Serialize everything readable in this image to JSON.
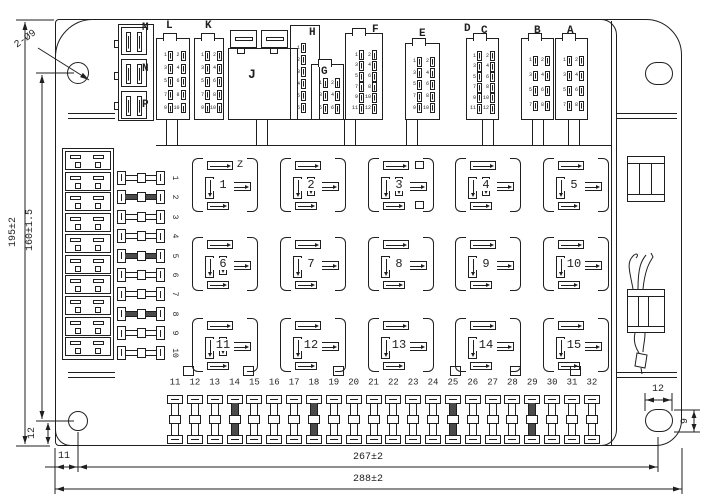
{
  "drawing": {
    "type": "fuse-and-relay-box engineering drawing",
    "line_color": "#1f1f1f",
    "bg_color": "#ffffff"
  },
  "dimensions": {
    "hole_callout": "2-Ø9",
    "height_overall": "195±2",
    "height_holes": "160±1.5",
    "bottom_offset_left": "12",
    "left_offset": "11",
    "width_holes": "267±2",
    "width_overall": "288±2",
    "slot_width": "12",
    "slot_height": "9"
  },
  "connectors": {
    "labels": {
      "m": "M",
      "n": "N",
      "p": "P",
      "l": "L",
      "k": "K",
      "j": "J",
      "h": "H",
      "g": "G",
      "f": "F",
      "e": "E",
      "d": "D",
      "c": "C",
      "b": "B",
      "a": "A"
    },
    "blocks": [
      {
        "id": "L",
        "rows": 5,
        "cols": 2,
        "pins": [
          "1",
          "3",
          "5",
          "7",
          "9",
          "2",
          "4",
          "6",
          "8",
          "10"
        ]
      },
      {
        "id": "K",
        "rows": 5,
        "cols": 2,
        "pins": [
          "1",
          "3",
          "5",
          "7",
          "9",
          "2",
          "4",
          "6",
          "8",
          "10"
        ]
      },
      {
        "id": "H",
        "rows": 6,
        "cols": 1,
        "pins": [
          "1",
          "2",
          "3",
          "4",
          "5",
          "6"
        ]
      },
      {
        "id": "G",
        "rows": 3,
        "cols": 2,
        "pins": [
          "1",
          "3",
          "5",
          "2",
          "4",
          "6"
        ]
      },
      {
        "id": "F",
        "rows": 6,
        "cols": 2,
        "pins": [
          "1",
          "3",
          "5",
          "7",
          "9",
          "11",
          "2",
          "4",
          "6",
          "8",
          "10",
          "12"
        ]
      },
      {
        "id": "E",
        "rows": 5,
        "cols": 2,
        "pins": [
          "1",
          "3",
          "5",
          "7",
          "9",
          "2",
          "4",
          "6",
          "8",
          "10"
        ]
      },
      {
        "id": "DC",
        "rows": 6,
        "cols": 2,
        "pins": [
          "1",
          "3",
          "5",
          "7",
          "9",
          "11",
          "2",
          "4",
          "6",
          "8",
          "10",
          "12"
        ]
      },
      {
        "id": "B",
        "rows": 4,
        "cols": 2,
        "pins": [
          "1",
          "3",
          "5",
          "7",
          "2",
          "4",
          "6",
          "8"
        ]
      },
      {
        "id": "A",
        "rows": 4,
        "cols": 2,
        "pins": [
          "1",
          "3",
          "5",
          "7",
          "2",
          "4",
          "6",
          "8"
        ]
      }
    ]
  },
  "relays": {
    "z_label": "Z",
    "sockets": [
      {
        "n": "1",
        "mid": false,
        "extra": false
      },
      {
        "n": "2",
        "mid": true,
        "extra": false
      },
      {
        "n": "3",
        "mid": true,
        "extra": true
      },
      {
        "n": "4",
        "mid": true,
        "extra": false
      },
      {
        "n": "5",
        "mid": false,
        "extra": false
      },
      {
        "n": "6",
        "mid": true,
        "extra": false
      },
      {
        "n": "7",
        "mid": false,
        "extra": false
      },
      {
        "n": "8",
        "mid": false,
        "extra": false
      },
      {
        "n": "9",
        "mid": false,
        "extra": false
      },
      {
        "n": "10",
        "mid": false,
        "extra": false
      },
      {
        "n": "11",
        "mid": true,
        "extra": false
      },
      {
        "n": "12",
        "mid": false,
        "extra": false
      },
      {
        "n": "13",
        "mid": false,
        "extra": false
      },
      {
        "n": "14",
        "mid": false,
        "extra": false
      },
      {
        "n": "15",
        "mid": false,
        "extra": false
      }
    ]
  },
  "fuses": {
    "left_column": [
      {
        "n": "1",
        "shaded": false
      },
      {
        "n": "2",
        "shaded": true
      },
      {
        "n": "3",
        "shaded": false
      },
      {
        "n": "4",
        "shaded": false
      },
      {
        "n": "5",
        "shaded": true
      },
      {
        "n": "6",
        "shaded": false
      },
      {
        "n": "7",
        "shaded": false
      },
      {
        "n": "8",
        "shaded": true
      },
      {
        "n": "9",
        "shaded": false
      },
      {
        "n": "10",
        "shaded": false
      }
    ],
    "bottom_row": [
      {
        "n": "11",
        "shaded": false
      },
      {
        "n": "12",
        "shaded": false
      },
      {
        "n": "13",
        "shaded": false
      },
      {
        "n": "14",
        "shaded": true
      },
      {
        "n": "15",
        "shaded": false
      },
      {
        "n": "16",
        "shaded": false
      },
      {
        "n": "17",
        "shaded": false
      },
      {
        "n": "18",
        "shaded": true
      },
      {
        "n": "19",
        "shaded": false
      },
      {
        "n": "20",
        "shaded": false
      },
      {
        "n": "21",
        "shaded": false
      },
      {
        "n": "22",
        "shaded": false
      },
      {
        "n": "23",
        "shaded": false
      },
      {
        "n": "24",
        "shaded": false
      },
      {
        "n": "25",
        "shaded": true
      },
      {
        "n": "26",
        "shaded": false
      },
      {
        "n": "27",
        "shaded": false
      },
      {
        "n": "28",
        "shaded": false
      },
      {
        "n": "29",
        "shaded": true
      },
      {
        "n": "30",
        "shaded": false
      },
      {
        "n": "31",
        "shaded": false
      },
      {
        "n": "32",
        "shaded": false
      }
    ]
  }
}
